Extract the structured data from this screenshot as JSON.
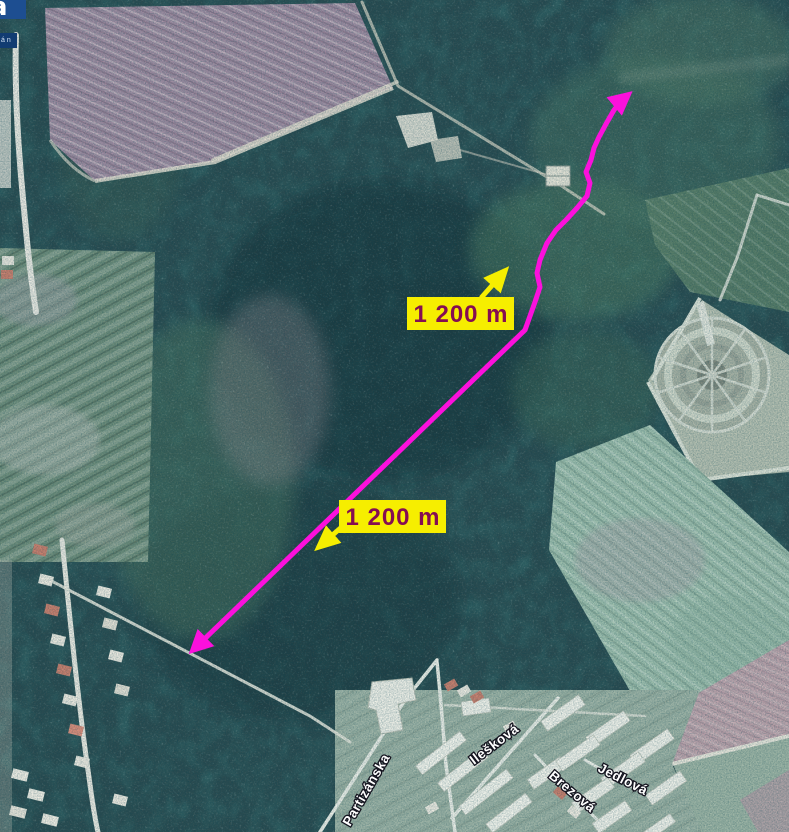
{
  "logo": {
    "glyph": "a",
    "subtext": "á n"
  },
  "labels": {
    "upper": "1 200 m",
    "lower": "1 200 m"
  },
  "streets": [
    {
      "name": "Partizánska"
    },
    {
      "name": "Ilešková"
    },
    {
      "name": "Brezová"
    },
    {
      "name": "Jedlová"
    }
  ],
  "colors": {
    "route": "#fb10dc",
    "arrow": "#f6ee00",
    "label_bg": "#f6ee00",
    "label_text": "#850d52",
    "street_text": "#ffffff"
  }
}
